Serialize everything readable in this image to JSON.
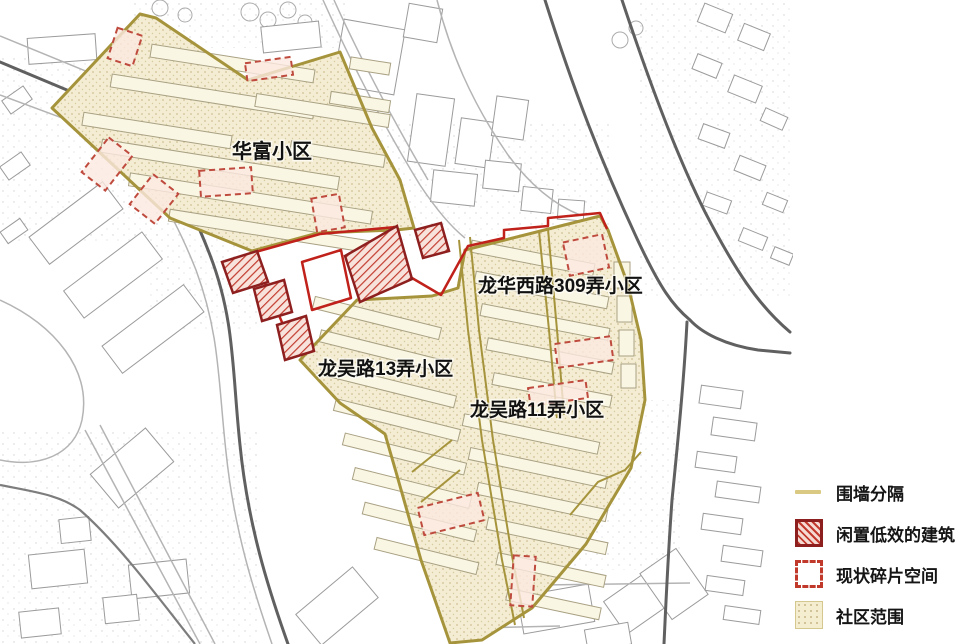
{
  "map": {
    "area_labels": [
      {
        "id": "huafu",
        "text": "华富小区"
      },
      {
        "id": "longhuaxilu-309",
        "text": "龙华西路309弄小区"
      },
      {
        "id": "longwulu-13",
        "text": "龙吴路13弄小区"
      },
      {
        "id": "longwulu-11",
        "text": "龙吴路11弄小区"
      }
    ]
  },
  "legend": {
    "items": [
      {
        "key": "wall-separation",
        "label": "围墙分隔",
        "swatch": "line"
      },
      {
        "key": "idle-buildings",
        "label": "闲置低效的建筑",
        "swatch": "hatched"
      },
      {
        "key": "fragment-space",
        "label": "现状碎片空间",
        "swatch": "dashed"
      },
      {
        "key": "community-extent",
        "label": "社区范围",
        "swatch": "dotted-fill"
      }
    ]
  },
  "colors": {
    "community_fill": "#f4edd3",
    "community_dot": "#cfc193",
    "boundary_olive": "#a6943c",
    "legend_wall_line": "#d9c982",
    "idle_border": "#8e1f1f",
    "idle_hatch": "#c23b2e",
    "fragment_stroke": "#bf4a3e",
    "fragment_fill": "#fbe9e0",
    "red_boundary": "#c0211a",
    "road_dark": "#606060",
    "road_light": "#b4b4b4",
    "building_outline": "#9b9b9b",
    "label_text": "#111111"
  },
  "map_geometry": {
    "background_buildings": [
      [
        28,
        36,
        68,
        26,
        -4
      ],
      [
        112,
        78,
        84,
        26,
        -8
      ],
      [
        4,
        92,
        26,
        16,
        -35
      ],
      [
        2,
        158,
        26,
        16,
        -35
      ],
      [
        2,
        224,
        24,
        14,
        -35
      ],
      [
        30,
        206,
        92,
        34,
        -37
      ],
      [
        64,
        258,
        98,
        34,
        -37
      ],
      [
        102,
        312,
        102,
        34,
        -37
      ],
      [
        262,
        24,
        58,
        26,
        -6
      ],
      [
        338,
        24,
        62,
        66,
        10
      ],
      [
        406,
        6,
        34,
        34,
        10
      ],
      [
        412,
        96,
        38,
        68,
        8
      ],
      [
        458,
        120,
        34,
        46,
        8
      ],
      [
        494,
        98,
        32,
        40,
        8
      ],
      [
        432,
        172,
        44,
        32,
        6
      ],
      [
        484,
        162,
        36,
        28,
        6
      ],
      [
        522,
        188,
        30,
        24,
        6
      ],
      [
        558,
        200,
        26,
        20,
        4
      ],
      [
        96,
        446,
        72,
        44,
        -40
      ],
      [
        30,
        552,
        56,
        34,
        -6
      ],
      [
        130,
        562,
        58,
        34,
        -6
      ],
      [
        60,
        518,
        30,
        24,
        -6
      ],
      [
        104,
        596,
        34,
        26,
        -6
      ],
      [
        20,
        610,
        40,
        26,
        -6
      ],
      [
        300,
        586,
        74,
        40,
        -40
      ],
      [
        436,
        566,
        62,
        34,
        -14
      ],
      [
        520,
        590,
        72,
        38,
        -10
      ],
      [
        610,
        582,
        56,
        40,
        -35
      ],
      [
        652,
        556,
        44,
        56,
        -35
      ],
      [
        586,
        626,
        44,
        22,
        -10
      ],
      [
        700,
        8,
        30,
        20,
        22
      ],
      [
        740,
        28,
        28,
        18,
        22
      ],
      [
        694,
        58,
        26,
        16,
        22
      ],
      [
        730,
        80,
        30,
        18,
        22
      ],
      [
        762,
        112,
        24,
        14,
        24
      ],
      [
        700,
        128,
        28,
        16,
        20
      ],
      [
        736,
        160,
        28,
        16,
        22
      ],
      [
        704,
        196,
        26,
        14,
        20
      ],
      [
        764,
        196,
        22,
        13,
        22
      ],
      [
        740,
        232,
        26,
        14,
        22
      ],
      [
        772,
        250,
        20,
        12,
        22
      ],
      [
        700,
        388,
        42,
        18,
        8
      ],
      [
        712,
        420,
        44,
        18,
        8
      ],
      [
        696,
        454,
        40,
        16,
        8
      ],
      [
        716,
        484,
        44,
        16,
        8
      ],
      [
        702,
        516,
        40,
        16,
        8
      ],
      [
        722,
        548,
        40,
        16,
        8
      ],
      [
        706,
        578,
        38,
        15,
        8
      ],
      [
        724,
        608,
        36,
        14,
        8
      ]
    ],
    "community_buildings": [
      [
        150,
        57,
        165,
        13,
        9
      ],
      [
        110,
        90,
        205,
        13,
        9
      ],
      [
        82,
        124,
        150,
        13,
        9
      ],
      [
        255,
        104,
        135,
        13,
        9
      ],
      [
        100,
        158,
        240,
        13,
        9
      ],
      [
        290,
        148,
        95,
        12,
        9
      ],
      [
        128,
        192,
        245,
        13,
        9
      ],
      [
        168,
        226,
        215,
        12,
        9
      ],
      [
        330,
        96,
        60,
        12,
        9
      ],
      [
        350,
        60,
        40,
        12,
        9
      ],
      [
        470,
        252,
        125,
        12,
        11
      ],
      [
        474,
        284,
        135,
        12,
        11
      ],
      [
        480,
        316,
        130,
        12,
        11
      ],
      [
        486,
        350,
        128,
        12,
        11
      ],
      [
        492,
        384,
        120,
        12,
        11
      ],
      [
        614,
        262,
        16,
        26,
        0
      ],
      [
        617,
        296,
        15,
        26,
        0
      ],
      [
        619,
        330,
        15,
        26,
        0
      ],
      [
        621,
        364,
        15,
        24,
        0
      ],
      [
        312,
        312,
        130,
        12,
        14
      ],
      [
        318,
        346,
        135,
        12,
        14
      ],
      [
        325,
        380,
        132,
        12,
        14
      ],
      [
        333,
        414,
        128,
        12,
        14
      ],
      [
        342,
        448,
        125,
        12,
        14
      ],
      [
        352,
        482,
        120,
        12,
        14
      ],
      [
        362,
        516,
        115,
        12,
        14
      ],
      [
        374,
        550,
        105,
        12,
        14
      ],
      [
        462,
        428,
        138,
        12,
        12
      ],
      [
        468,
        462,
        140,
        12,
        12
      ],
      [
        476,
        496,
        132,
        12,
        12
      ],
      [
        486,
        530,
        122,
        12,
        12
      ],
      [
        496,
        564,
        110,
        12,
        12
      ],
      [
        506,
        598,
        95,
        12,
        12
      ]
    ],
    "fragment_spaces": [
      [
        92,
        142,
        30,
        44,
        38
      ],
      [
        138,
        180,
        32,
        38,
        38
      ],
      [
        200,
        169,
        52,
        26,
        -4
      ],
      [
        112,
        31,
        26,
        32,
        18
      ],
      [
        314,
        196,
        28,
        34,
        -10
      ],
      [
        246,
        60,
        46,
        18,
        -8
      ],
      [
        566,
        238,
        40,
        34,
        -12
      ],
      [
        556,
        340,
        56,
        24,
        -8
      ],
      [
        529,
        384,
        58,
        18,
        -8
      ],
      [
        420,
        500,
        62,
        28,
        -14
      ],
      [
        512,
        556,
        22,
        50,
        4
      ]
    ],
    "idle_buildings": [
      "222,262 257,251 268,282 233,293",
      "254,289 284,280 292,312 262,321",
      "277,325 306,316 314,351 285,360",
      "345,256 397,226 412,279 360,302",
      "415,230 441,223 449,251 423,258"
    ]
  }
}
